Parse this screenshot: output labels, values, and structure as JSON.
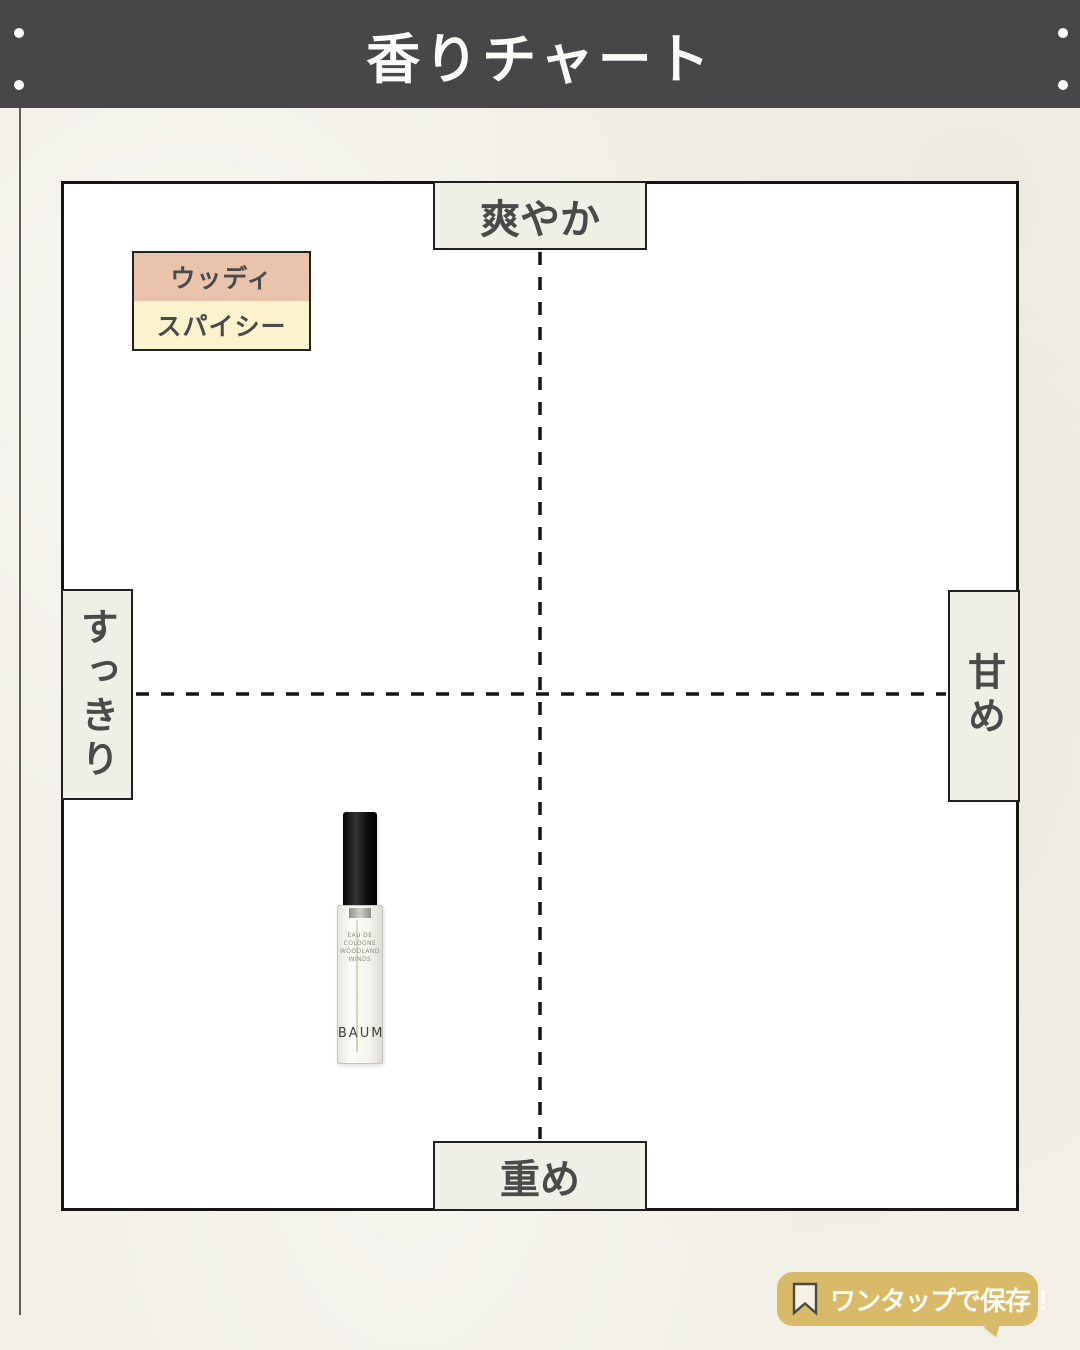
{
  "page": {
    "background_color": "#f1efe6"
  },
  "header": {
    "title": "香りチャート",
    "background_color": "#47474a",
    "text_color": "#fbfbfa"
  },
  "chart": {
    "dash_color": "#141414",
    "axis_labels": {
      "top": "爽やか",
      "bottom": "重め",
      "left": "すっきり",
      "right": "甘め"
    },
    "legend": [
      {
        "label": "ウッディ",
        "color": "#e9c3ab"
      },
      {
        "label": "スパイシー",
        "color": "#fbf3cd"
      }
    ]
  },
  "bottle": {
    "brand": "BAUM",
    "label_lines": [
      "EAU DE",
      "COLOGNE",
      "WOODLAND",
      "WINDS"
    ]
  },
  "badge": {
    "label": "ワンタップで保存！",
    "icon": "bookmark-icon",
    "background_color": "#d9ba69"
  },
  "chart_data": {
    "type": "scatter",
    "title": "香りチャート",
    "x_axis": {
      "left_label": "すっきり",
      "right_label": "甘め"
    },
    "y_axis": {
      "top_label": "爽やか",
      "bottom_label": "重め"
    },
    "xlim": [
      -1,
      1
    ],
    "ylim": [
      -1,
      1
    ],
    "grid": "dashed-crosshair",
    "legend_entries": [
      "ウッディ",
      "スパイシー"
    ],
    "points": [
      {
        "name": "BAUM EAU DE COLOGNE WOODLAND WINDS",
        "x": -0.38,
        "y": -0.47,
        "x_frac": 0.312,
        "y_frac": 0.735,
        "categories": [
          "ウッディ",
          "スパイシー"
        ]
      }
    ]
  }
}
